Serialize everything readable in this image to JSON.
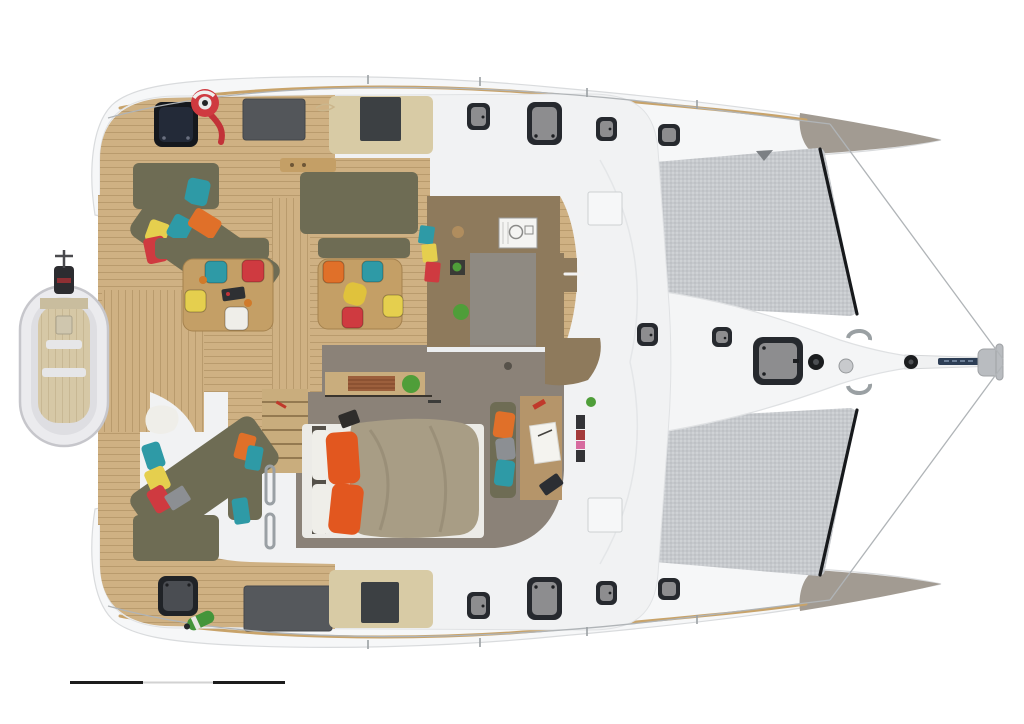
{
  "meta": {
    "subject": "Top-down deck and interior floor plan rendering of a sailing catamaran, bow pointing right",
    "view": "top-down cutaway render",
    "orientation": "bow-right",
    "canvas": {
      "width": 1024,
      "height": 724
    },
    "background": "#ffffff",
    "visible_text": "none"
  },
  "palette": {
    "hull_white": "#f6f7f8",
    "deck_white": "#f1f2f3",
    "outline": "#d9dbdd",
    "wood": "#cfb183",
    "wood_mid": "#c2a372",
    "wood_table": "#c49f66",
    "counter_brown": "#8e7a5c",
    "tan_panel": "#d8cba5",
    "olive": "#6e6c54",
    "khaki": "#a89d85",
    "gray_floor": "#8b8278",
    "galley_gray": "#8f8a82",
    "mesh_edge": "#17191c",
    "hatch_frame": "#26292e",
    "hatch_glass": "#8d8d8f",
    "hatch_navy": "#232a38",
    "red": "#cf3a40",
    "orange": "#e07029",
    "orange_deep": "#e2571f",
    "teal": "#2e9aa6",
    "yellow": "#e5cf4e",
    "green": "#4f9e39",
    "white_soft": "#efeee9",
    "gray_pillow": "#8c8f93",
    "chrome": "#b9bcc0",
    "lifeline": "#b0b4b7",
    "toe_rail": "#c8a36a",
    "gray_window": "#53565a",
    "dark_window": "#3c4043",
    "bow_shade": "#a29b92",
    "navy_strip": "#2d3e55",
    "scale_black": "#1c1c1c",
    "scale_gray": "#d2d2d2"
  },
  "scale_bar": {
    "y": 681,
    "segments": [
      {
        "x": 70,
        "width": 73,
        "height": 3,
        "color_key": "scale_black"
      },
      {
        "x": 143,
        "width": 70,
        "height": 2,
        "color_key": "scale_gray"
      },
      {
        "x": 213,
        "width": 72,
        "height": 3,
        "color_key": "scale_black"
      }
    ]
  },
  "regions": [
    {
      "name": "port-hull",
      "desc": "upper white hull with 4 deck hatches and tan toe rail"
    },
    {
      "name": "starboard-hull",
      "desc": "lower white hull with 4 deck hatches and tan toe rail"
    },
    {
      "name": "trampoline-port",
      "desc": "gray mesh net between port hull and bow nacelle"
    },
    {
      "name": "trampoline-starboard",
      "desc": "gray mesh net between starboard hull and bow nacelle"
    },
    {
      "name": "bow-nacelle",
      "desc": "central white bow wedge with bowsprit, cleats, windlass and anchor roller"
    },
    {
      "name": "salon",
      "desc": "olive sofas, two wood tables with teal/red/yellow/orange/white stools, colorful pillows"
    },
    {
      "name": "galley",
      "desc": "brown L counters, white sink-stove unit, plants, hanging towels"
    },
    {
      "name": "master-cabin",
      "desc": "khaki double bed, orange pillows, desk with papers, olive settee"
    },
    {
      "name": "aft-lounge",
      "desc": "olive chaises with teal/yellow/red pillows, white towel"
    },
    {
      "name": "aft-deck",
      "desc": "teak platform with dinghy on davits, outboard engine, red horseshoe buoy, green fender"
    },
    {
      "name": "scale-bar",
      "desc": "black-gray-black drawing scale segments at bottom left"
    }
  ],
  "counts": {
    "deck_hatches": 14,
    "dining_tables": 2,
    "stools": 8,
    "trampolines": 2
  }
}
